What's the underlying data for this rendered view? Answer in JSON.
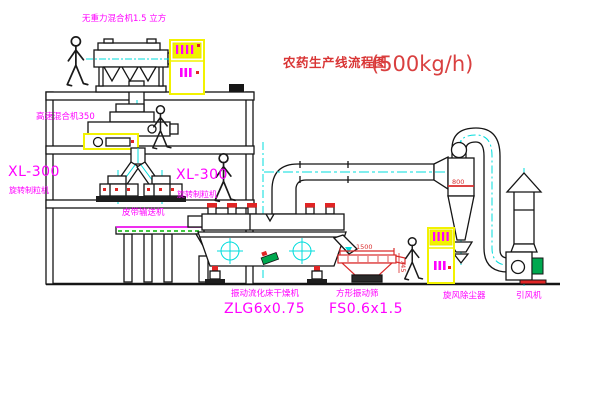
{
  "title": {
    "text": "农药生产线流程图",
    "capacity": "(500kg/h)"
  },
  "equipment_labels": {
    "gravity_mixer": "无重力混合机1.5 立方",
    "high_speed_mixer": "高速混合机350",
    "granulator_left": {
      "model": "XL-300",
      "name": "旋转制粒机"
    },
    "granulator_right": {
      "model": "XL-300",
      "name": "旋转制粒机"
    },
    "belt_conveyor": "皮带输送机",
    "fluid_bed_dryer": {
      "name": "振动流化床干燥机",
      "model": "ZLG6x0.75"
    },
    "square_sieve": {
      "name": "方形振动筛",
      "model": "FS0.6x1.5"
    },
    "cyclone": "旋风除尘器",
    "induced_draft_fan": "引风机"
  },
  "dimensions": {
    "sieve_length": "1500",
    "sieve_height": "745",
    "cyclone_level": "800"
  },
  "colors": {
    "label_magenta": "#ff00ff",
    "title_red": "#d93535",
    "centerline_cyan": "#00dcdc",
    "cabinet_yellow": "#f2f200",
    "accent_red": "#e02525",
    "motor_green": "#00a84f",
    "conveyor_green": "#00b400",
    "line_black": "#151515",
    "background": "#ffffff"
  }
}
